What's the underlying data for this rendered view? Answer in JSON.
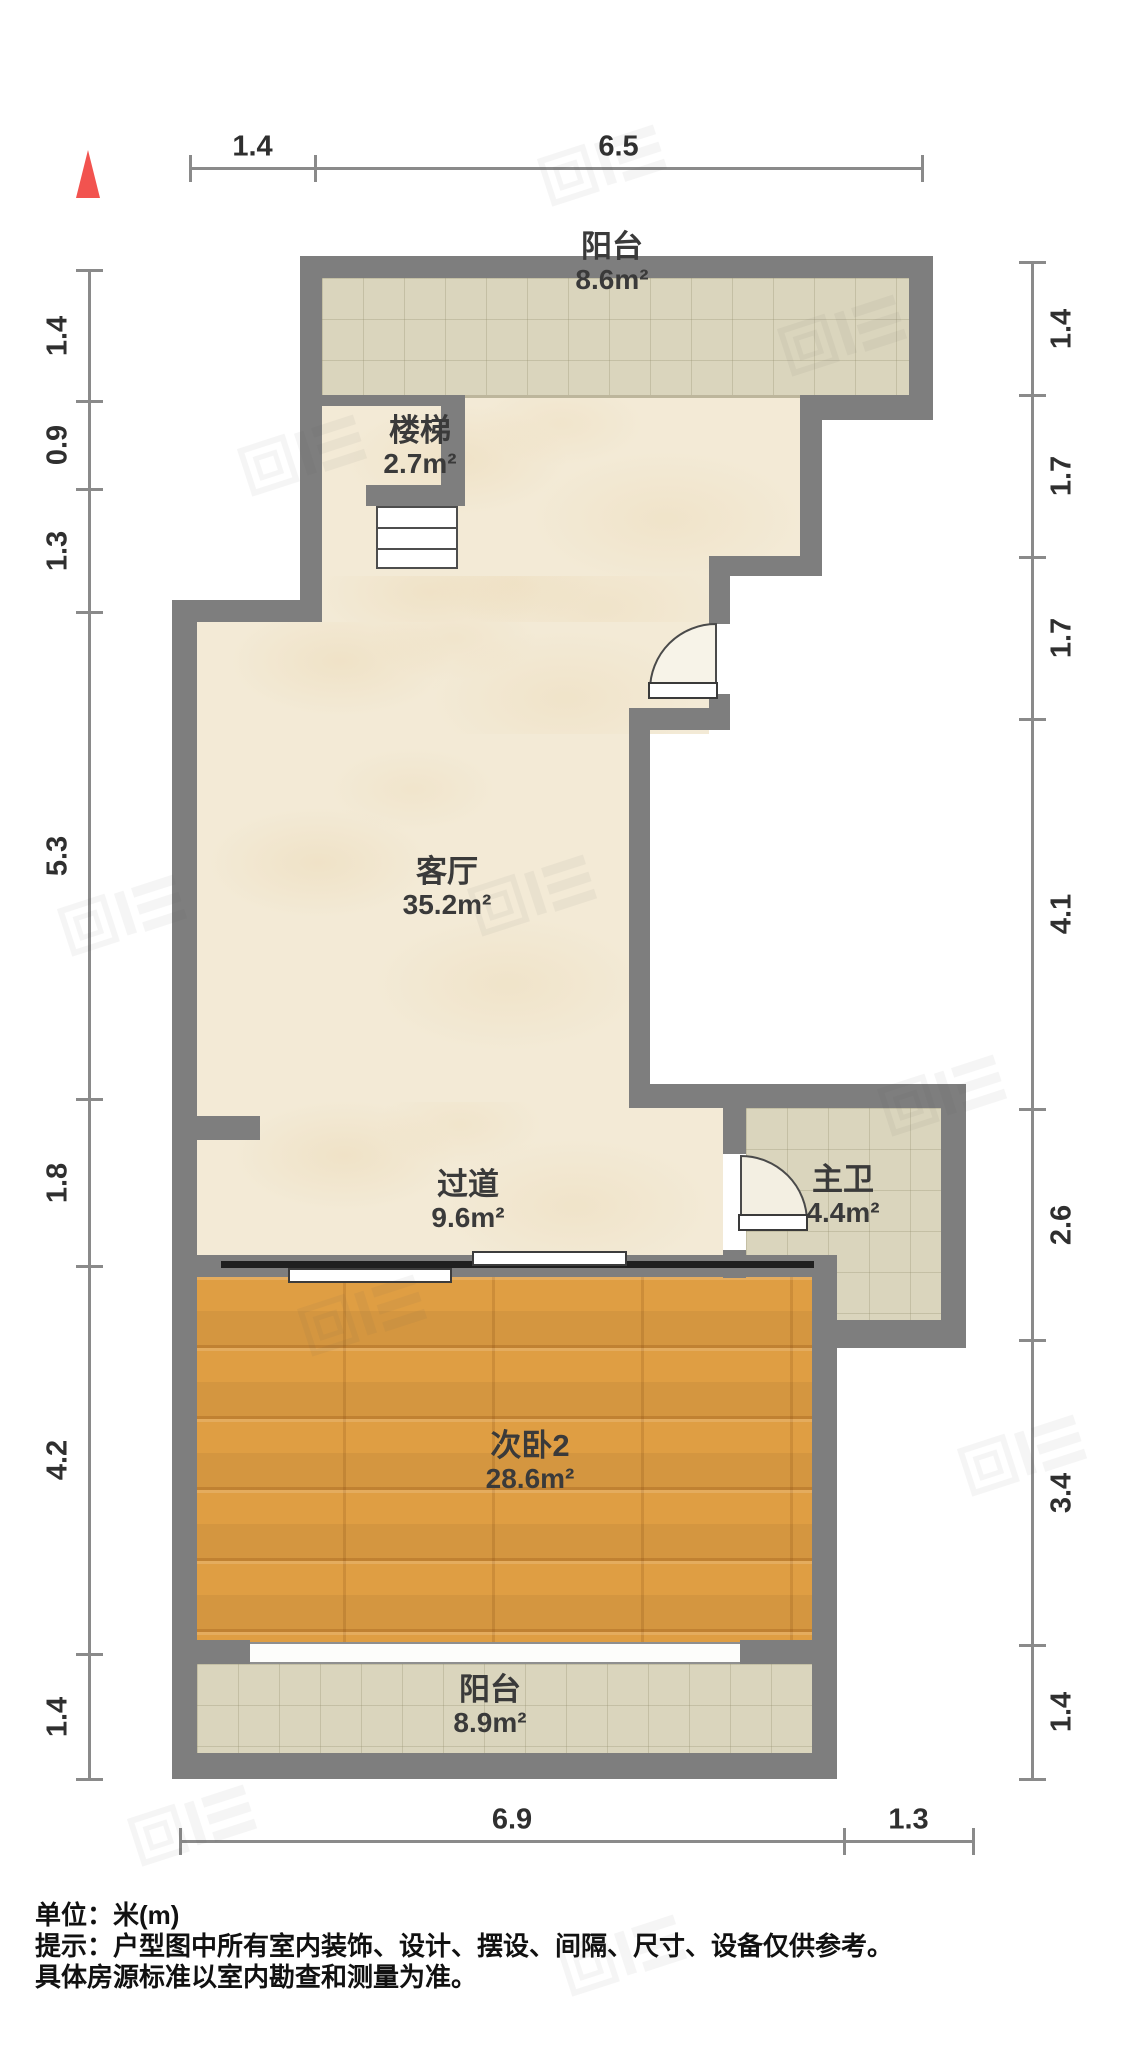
{
  "page": {
    "background": "#ffffff",
    "kind": "apartment floor plan"
  },
  "north_arrow": {
    "color": "#f2534f"
  },
  "rooms": [
    {
      "id": "balcony-top",
      "name": "阳台",
      "area": "8.6m²",
      "cx": 612,
      "ny": 230,
      "floor": "tile"
    },
    {
      "id": "stairs",
      "name": "楼梯",
      "area": "2.7m²",
      "cx": 420,
      "ny": 414,
      "floor": "beige"
    },
    {
      "id": "living-room",
      "name": "客厅",
      "area": "35.2m²",
      "cx": 447,
      "ny": 855,
      "floor": "beige"
    },
    {
      "id": "hallway",
      "name": "过道",
      "area": "9.6m²",
      "cx": 468,
      "ny": 1168,
      "floor": "beige"
    },
    {
      "id": "master-bath",
      "name": "主卫",
      "area": "4.4m²",
      "cx": 843,
      "ny": 1163,
      "floor": "tile"
    },
    {
      "id": "bedroom-2",
      "name": "次卧2",
      "area": "28.6m²",
      "cx": 530,
      "ny": 1429,
      "floor": "wood"
    },
    {
      "id": "balcony-bottom",
      "name": "阳台",
      "area": "8.9m²",
      "cx": 490,
      "ny": 1673,
      "floor": "tile"
    }
  ],
  "dimensions": {
    "unit_note": "单位：米(m)",
    "top": {
      "axis": 167,
      "ticks": [
        190,
        315,
        922
      ],
      "labels": [
        "1.4",
        "6.5"
      ]
    },
    "bottom": {
      "axis": 1840,
      "ticks": [
        180,
        844,
        973
      ],
      "labels": [
        "6.9",
        "1.3"
      ]
    },
    "left": {
      "axis": 88,
      "ticks": [
        270,
        401,
        489,
        612,
        1099,
        1266,
        1654,
        1779
      ],
      "labels": [
        "1.4",
        "0.9",
        "1.3",
        "5.3",
        "1.8",
        "4.2",
        "1.4"
      ]
    },
    "right": {
      "axis": 1031,
      "ticks": [
        262,
        395,
        557,
        719,
        1109,
        1340,
        1645,
        1779
      ],
      "labels": [
        "1.4",
        "1.7",
        "1.7",
        "4.1",
        "2.6",
        "3.4",
        "1.4"
      ]
    }
  },
  "footer": {
    "line1": "单位：米(m)",
    "line2": "提示：户型图中所有室内装饰、设计、摆设、间隔、尺寸、设备仅供参考。",
    "line3": "具体房源标准以室内勘查和测量为准。"
  },
  "colors": {
    "wall": "#7e7e7e",
    "marble_floor": "#f3ead6",
    "tile_floor": "#dad5bd",
    "wood_floor": "#df9e43",
    "dimension_text": "#2f2f2f",
    "north_arrow": "#f2534f",
    "door_track": "#1f1f1f"
  }
}
